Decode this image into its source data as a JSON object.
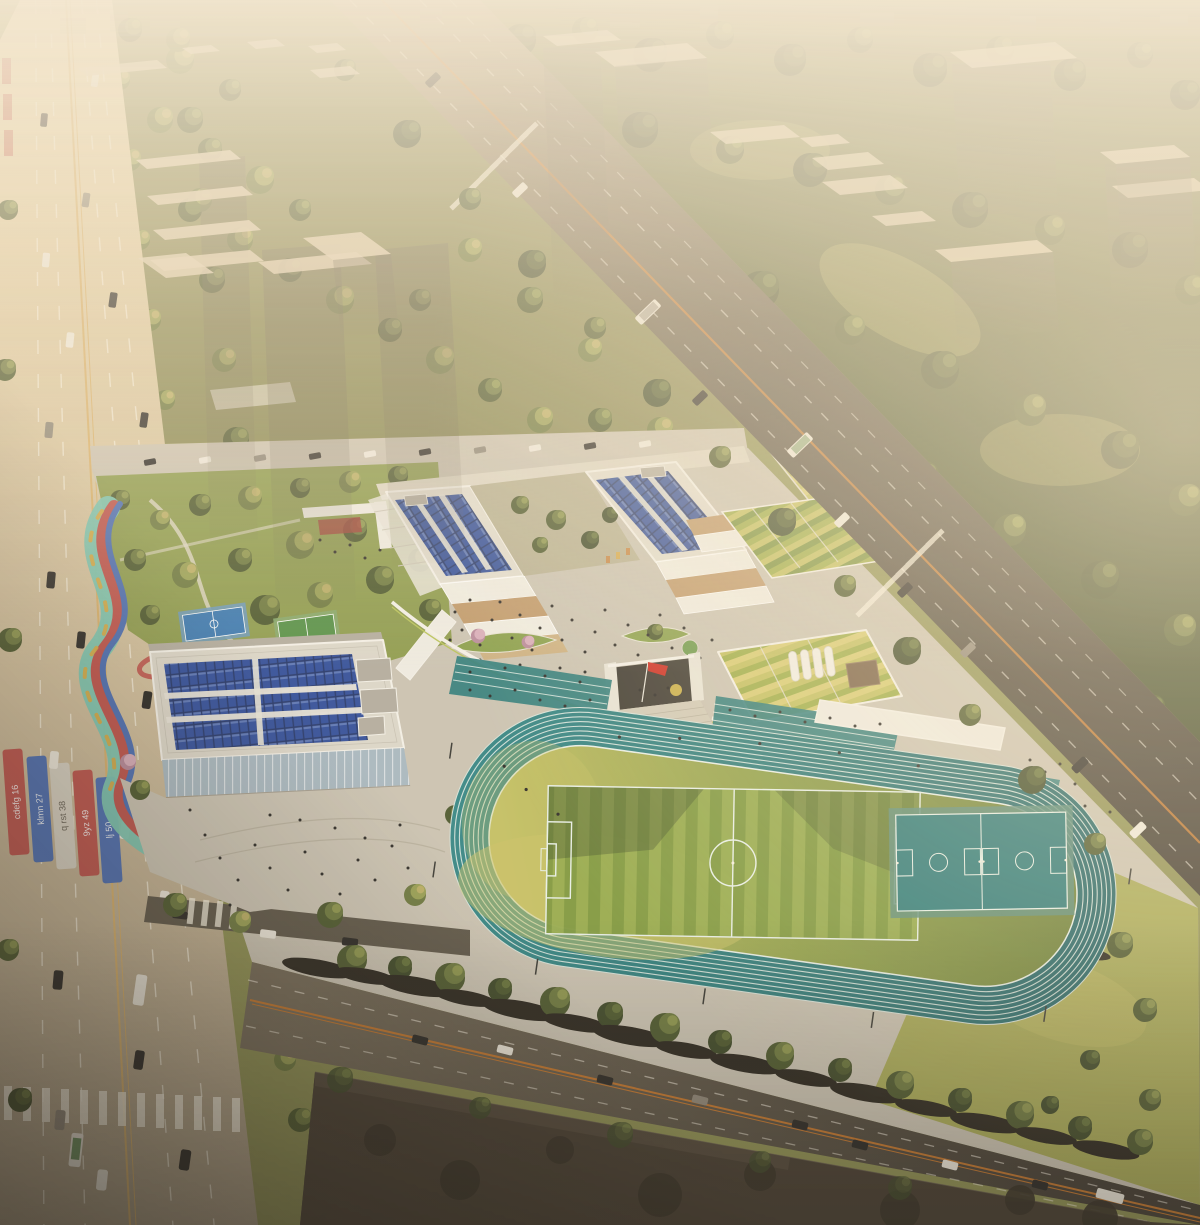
{
  "scene": {
    "type": "aerial-architectural-rendering",
    "subject": "school campus with solar panel roofs, green farm roofs, running track and sports courts, bounded by a wide sandy boulevard, a diagonal arterial road and dense urban forest with translucent ghost tower massings under warm haze"
  },
  "colors": {
    "base": "#8f9154",
    "skyline": "#a8a093",
    "forestMid": "#55613a",
    "treeDark": "#4e5a30",
    "treeMid": "#6e7a41",
    "treeLight": "#9aa156",
    "treeSun": "#c0b169",
    "blossom": "#d9aebc",
    "grassPark": "#8e9c4f",
    "lawnSun": "#c0bb66",
    "lawnSE": "#a8aa58",
    "laneWhite": "#f7f1e1",
    "laneYellow": "#d9b26d",
    "laneOrange": "#c4772f",
    "pave": "#cbc4b4",
    "paveLight": "#ded7c6",
    "white": "#efece3",
    "parapet": "#f4f1e9",
    "parapetGreen": "#b9c45c",
    "faceTan": "#c09a6c",
    "faceDark": "#8d7352",
    "faceGray": "#b3ada0",
    "glass": "#a9b9c2",
    "solarDeep": "#26386b",
    "solarBlue": "#33509c",
    "solarLight": "#7b93c9",
    "greenRoofA": "#9fae4a",
    "greenRoofB": "#c3c061",
    "greenRoofC": "#7c9440",
    "greenRoofPale": "#d8cc74",
    "hedge": "#5d6b37",
    "trackLine": "#e9f1ea",
    "fieldShadow": "#3a4829",
    "courtTeal": "#2e7b7a",
    "courtApron": "#5d8d7b",
    "courtBlue": "#3c7ab2",
    "courtGreen": "#579148",
    "ribbonTeal": "#7cc6b2",
    "ribbonRed": "#bf544d",
    "ribbonBlue": "#4d6fb4",
    "ribbonYellow": "#d9a843",
    "flagRed": "#cd2f25",
    "ghostRoof": "#e4d2b4",
    "darkBlock": "#473e33",
    "darkBlockTree": "#383228",
    "carWhite": "#efeade",
    "carDark": "#2c2a27",
    "carGray": "#8f8779",
    "busGreen": "#5d8a52",
    "people": "#2e2c29",
    "shadow": "#2c2820",
    "accentRed": "#a23f37",
    "roofBrown": "#7a6148",
    "pondGreen": "#6f9b4e",
    "bannerGray": "#d9d3c5",
    "stepGray": "#b9b2a0",
    "courtyardTan": "#b9b294"
  },
  "banners": [
    {
      "text": "cdefg 16"
    },
    {
      "text": "klmn 27"
    },
    {
      "text": "q rst 38"
    },
    {
      "text": "9yz 49"
    },
    {
      "text": "lj 50"
    }
  ],
  "track": {
    "lanes": 8,
    "soccer_field": true,
    "basketball_courts": 2
  },
  "flag": {
    "kind": "red-flag-on-pole"
  }
}
